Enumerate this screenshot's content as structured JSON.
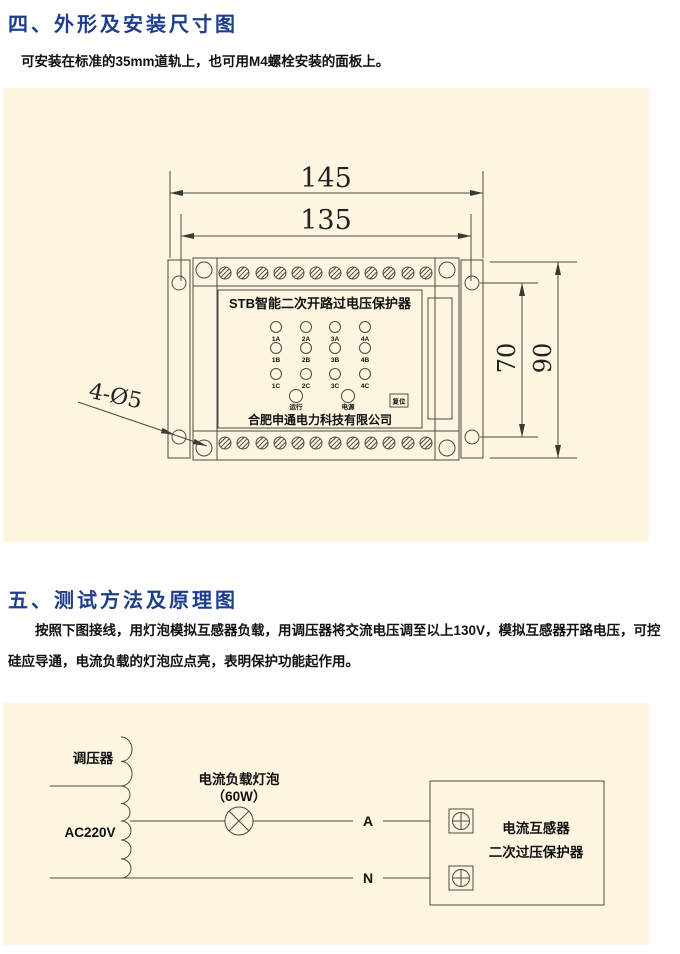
{
  "section_outline": {
    "heading": "四、外形及安装尺寸图",
    "body": "可安装在标准的35mm道轨上，也可用M4螺栓安装的面板上。"
  },
  "section_test": {
    "heading": "五、测试方法及原理图",
    "body": "按照下图接线，用灯泡模拟互感器负载，用调压器将交流电压调至以上130V，模拟互感器开路电压，可控硅应导通，电流负载的灯泡应点亮，表明保护功能起作用。"
  },
  "drawing": {
    "dim_width_outer": "145",
    "dim_width_holes": "135",
    "dim_height_holes": "70",
    "dim_height_outer": "90",
    "holes_label": "4-Ø5",
    "device": {
      "title": "STB智能二次开路过电压保护器",
      "leds": [
        [
          "1A",
          "2A",
          "3A",
          "4A"
        ],
        [
          "1B",
          "2B",
          "3B",
          "4B"
        ],
        [
          "1C",
          "2C",
          "3C",
          "4C"
        ]
      ],
      "run": "运行",
      "power": "电源",
      "reset": "复位",
      "company": "合肥申通电力科技有限公司"
    }
  },
  "circuit": {
    "regulator": "调压器",
    "source": "AC220V",
    "lamp_line1": "电流负载灯泡",
    "lamp_line2": "（60W）",
    "phase": "A",
    "neutral": "N",
    "device_line1": "电流互感器",
    "device_line2": "二次过压保护器"
  },
  "colors": {
    "heading": "#1d3e8f",
    "panel_bg": "#fdf5e0",
    "line": "#4a4a44"
  }
}
